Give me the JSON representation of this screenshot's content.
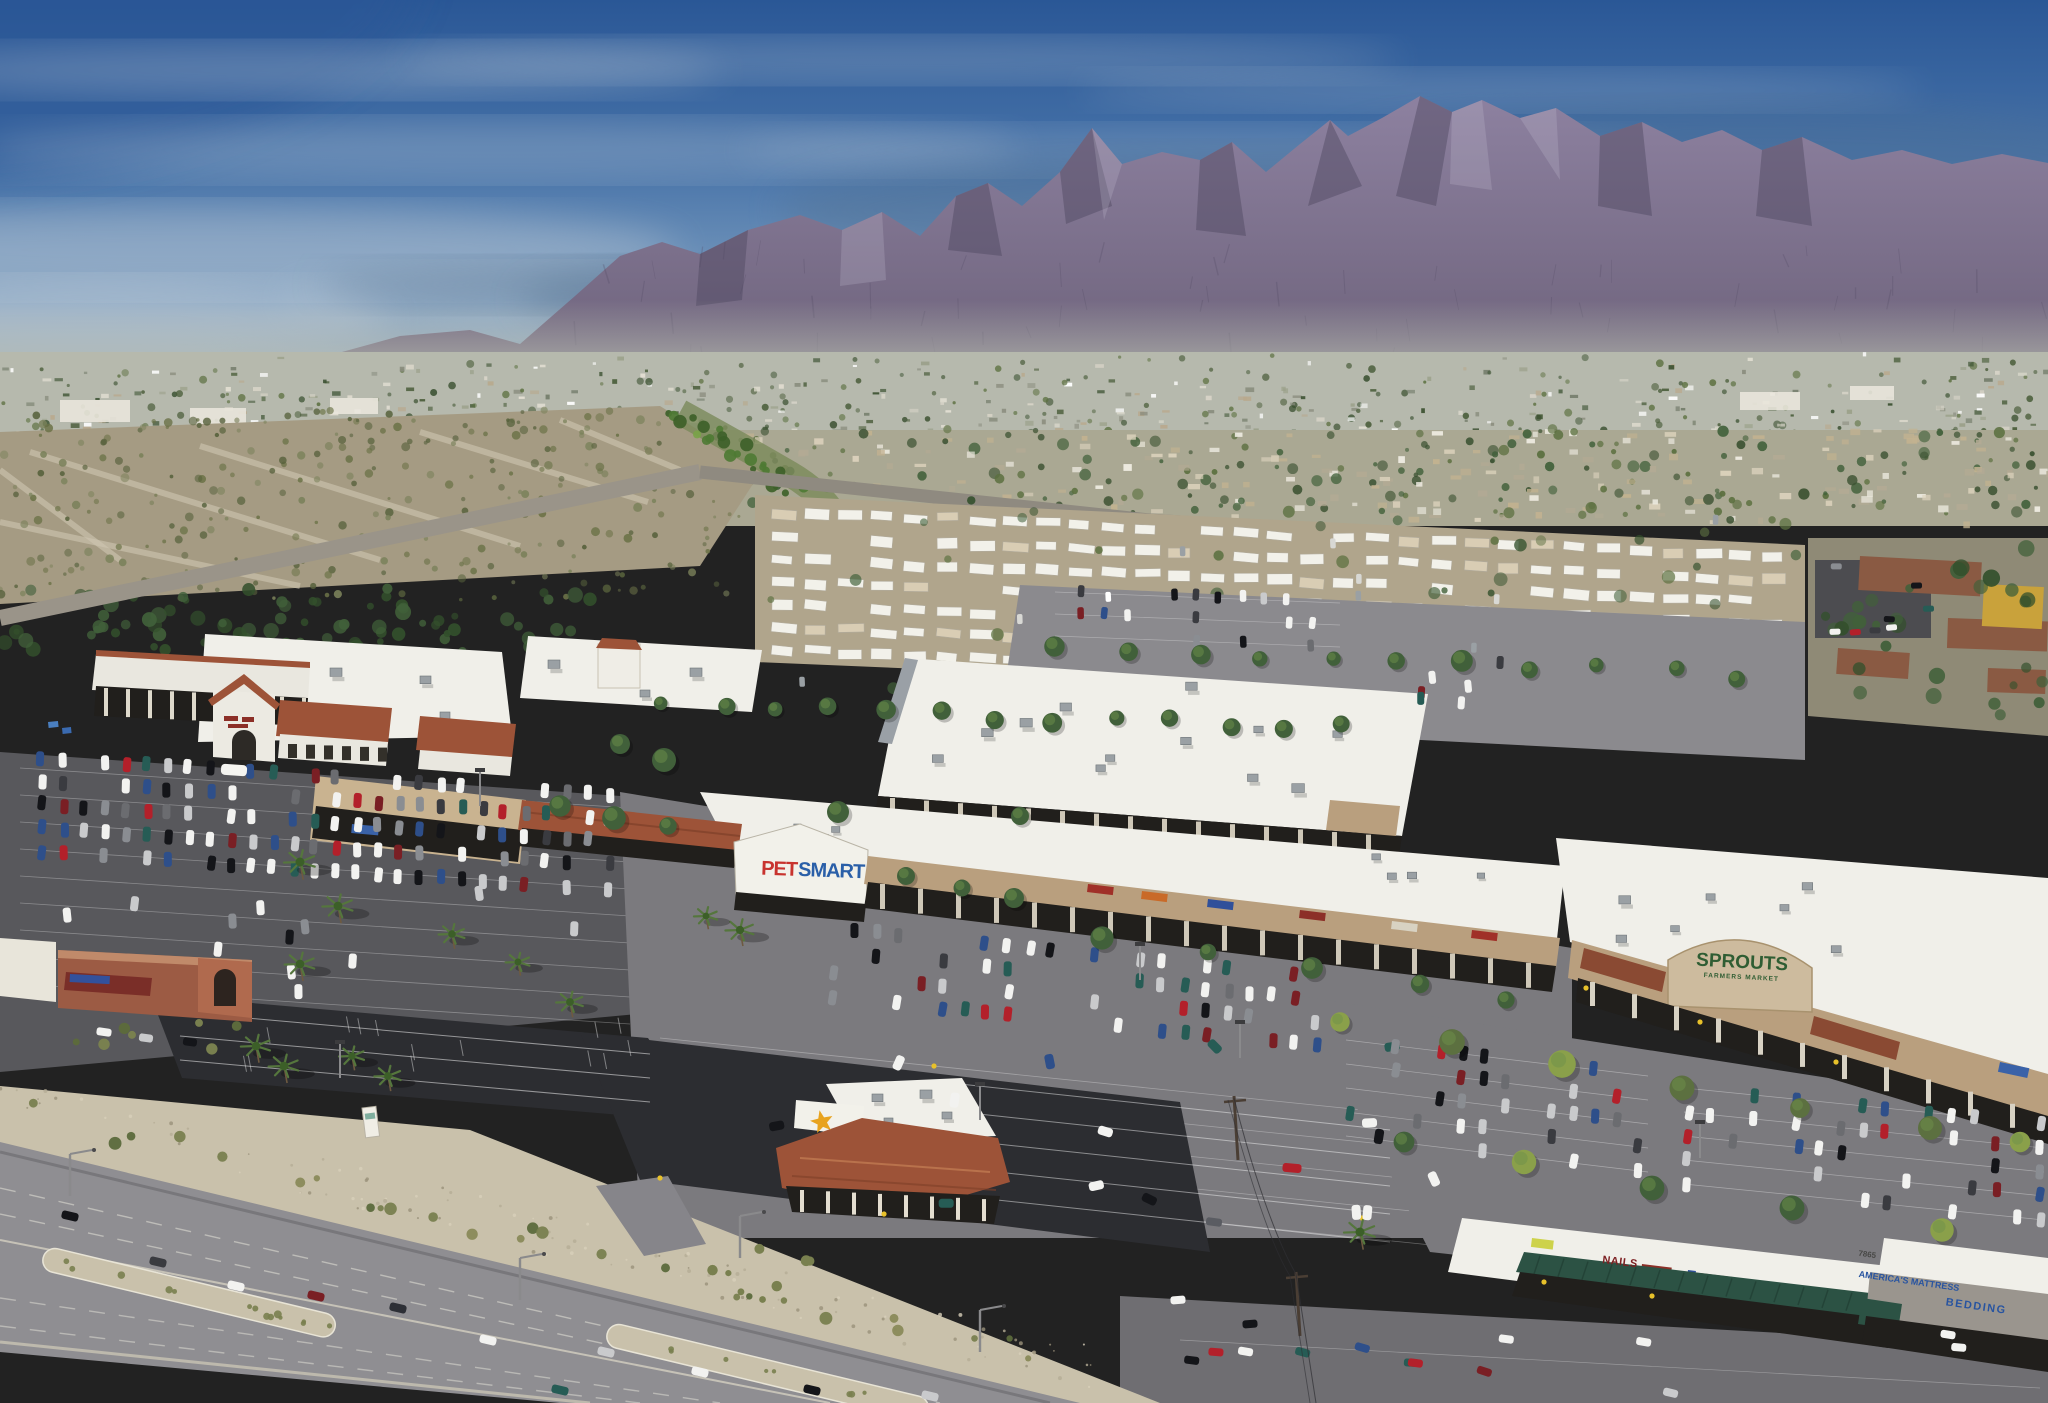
{
  "signs": {
    "petsmart": {
      "pet": "PET",
      "smart": "SMART"
    },
    "sprouts": {
      "name": "SPROUTS",
      "tagline": "FARMERS MARKET"
    },
    "nails": {
      "label": "NAILS"
    },
    "mattress": {
      "line1": "AMERICA'S MATTRESS",
      "line2": "BEDDING",
      "address": "7865"
    }
  },
  "palette": {
    "sky_top": "#2a5796",
    "sky_mid": "#4672a8",
    "sky_low": "#7b9cbe",
    "sky_horizon": "#a9bccb",
    "cloud": "#c7d1da",
    "storm_cloud": "#53708d",
    "mountain_top": "#8d81a0",
    "mountain_bottom": "#6b6078",
    "mountain_shadow": "#4e4660",
    "mountain_light": "#cfc8da",
    "haze": "#b8bcb1",
    "city_base": "#b6b9ad",
    "desert": "#a59b83",
    "scrub": "#6b7247",
    "suburb": "#aaa893",
    "mobile_ground": "#b0a58c",
    "home_white": "#f2f1ea",
    "home_tan": "#d9cdb4",
    "roof_white": "#f0efe9",
    "tile_roof": "#9d5338",
    "stucco": "#c9b390",
    "stucco_dark": "#b99f7e",
    "storefront_dark": "#211f1c",
    "asphalt_new": "#2c2d31",
    "asphalt": "#58585c",
    "asphalt_worn": "#7b7a7e",
    "road": "#8f8e92",
    "gravel": "#c9c1ab",
    "concrete": "#cfc9ba",
    "awning_green": "#2c5244",
    "awning_rust": "#8a4a33",
    "sprouts_green": "#2f5d33",
    "petsmart_red": "#c8332e",
    "petsmart_blue": "#2a5fa8",
    "sign_red": "#8c2f27",
    "mattress_blue": "#2854a0",
    "carls_star": "#e8a31f",
    "tree": "#41603a",
    "tree_light": "#6e8f4a",
    "palm_green": "#55763d",
    "bush": "#79804f",
    "apartment_roof": "#8a5a43",
    "apartment_yellow": "#c9a23b"
  }
}
